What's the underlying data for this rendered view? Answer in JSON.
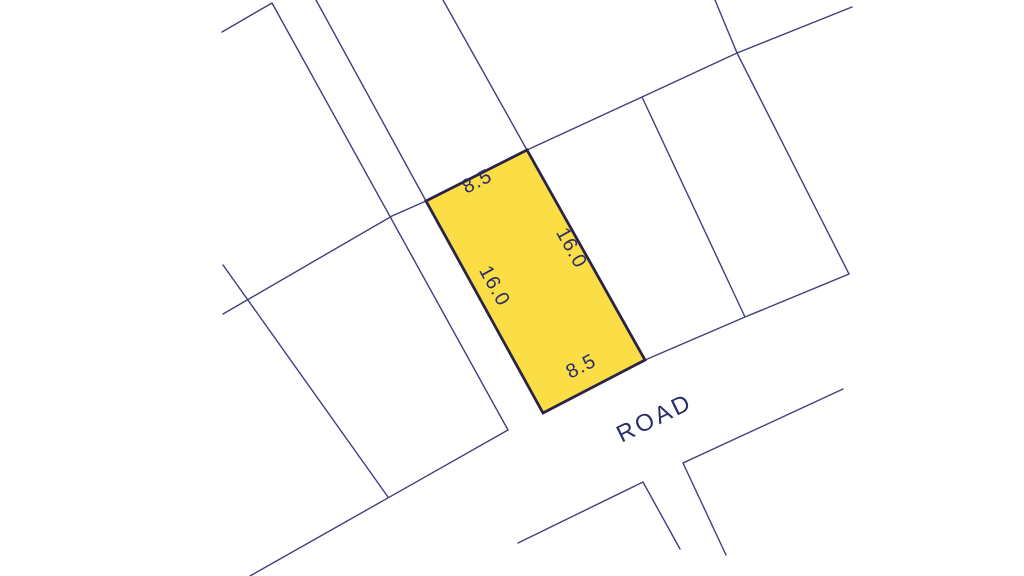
{
  "map": {
    "type": "cadastral-plot-map",
    "background_color": "#ffffff",
    "boundary_line_color": "#3f3f80",
    "text_color": "#2b2d6b",
    "road": {
      "label": "ROAD"
    },
    "parcel": {
      "fill_color": "#fbdd45",
      "border_color": "#2a2348",
      "dimensions": {
        "top": "8.5",
        "right": "16.0",
        "left": "16.0",
        "bottom": "8.5"
      }
    }
  }
}
